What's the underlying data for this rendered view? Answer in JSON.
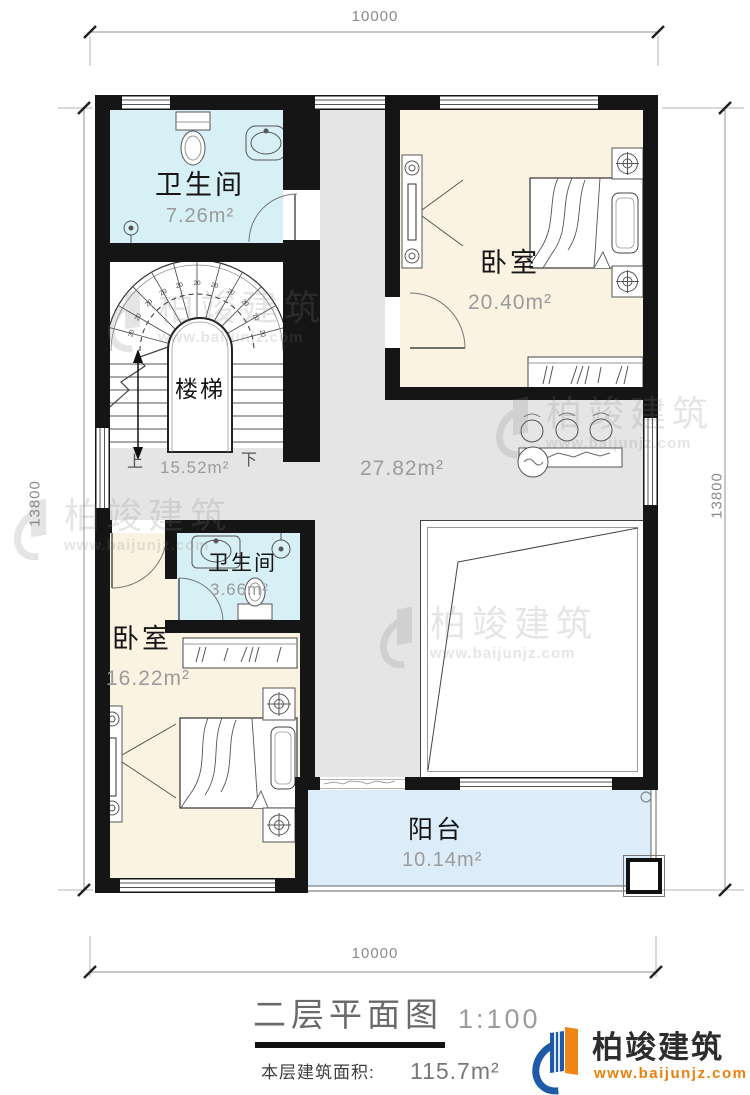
{
  "dimensions": {
    "top": "10000",
    "bottom": "10000",
    "left": "13800",
    "right": "13800"
  },
  "rooms": {
    "bath_top": {
      "name": "卫生间",
      "area": "7.26m²"
    },
    "stairs": {
      "name": "楼梯",
      "area": "15.52m²",
      "up_label": "上",
      "down_label": "下",
      "tread_label": "20"
    },
    "bedroom_top": {
      "name": "卧室",
      "area": "20.40m²"
    },
    "hall": {
      "area": "27.82m²"
    },
    "bath_mid": {
      "name": "卫生间",
      "area": "3.66m²"
    },
    "bedroom_bottom": {
      "name": "卧室",
      "area": "16.22m²"
    },
    "balcony": {
      "name": "阳台",
      "area": "10.14m²"
    }
  },
  "title_block": {
    "title": "二层平面图",
    "scale": "1:100",
    "floor_area_label": "本层建筑面积:",
    "floor_area_value": "115.7m²"
  },
  "brand": {
    "name": "柏竣建筑",
    "url": "www.baijunjz.com"
  },
  "watermark": {
    "name": "柏竣建筑",
    "url": "www.baijunjz.com"
  },
  "colors": {
    "wall": "#151515",
    "bathroom_fill": "#d7f0f5",
    "bedroom_fill": "#faf3e2",
    "hall_fill": "#e5e5e5",
    "balcony_fill": "#dcecf9",
    "brand_blue": "#1e5aa7",
    "brand_orange": "#ef8615",
    "url_orange": "#e8810e"
  }
}
